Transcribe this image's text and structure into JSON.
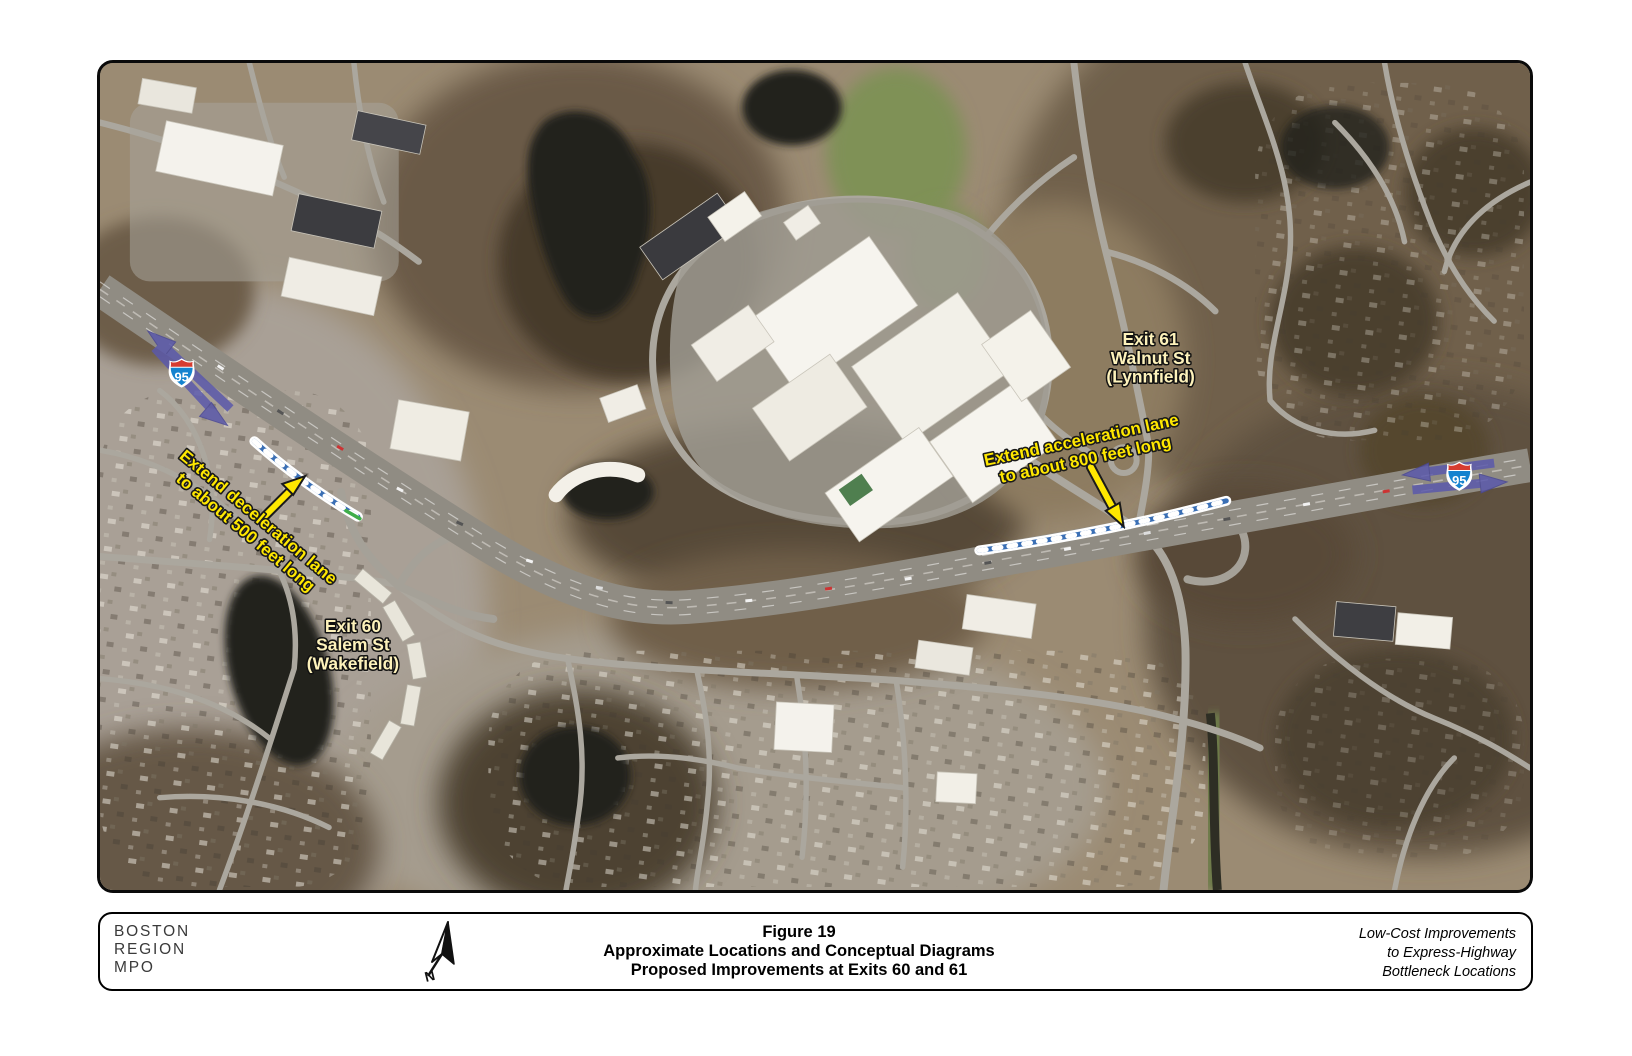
{
  "map": {
    "exit60": {
      "line1": "Exit 60",
      "line2": "Salem St",
      "line3": "(Wakefield)"
    },
    "exit61": {
      "line1": "Exit 61",
      "line2": "Walnut St",
      "line3": "(Lynnfield)"
    },
    "decel_note": {
      "line1": "Extend deceleration lane",
      "line2": "to about 500 feet long"
    },
    "accel_note": {
      "line1": "Extend acceleration lane",
      "line2": "to about 800 feet long"
    },
    "interstate_left": "95",
    "interstate_right": "95"
  },
  "footer": {
    "agency_line1": "BOSTON",
    "agency_line2": "REGION",
    "agency_line3": "MPO",
    "north_letter": "N",
    "figure_line1": "Figure 19",
    "figure_line2": "Approximate Locations and Conceptual Diagrams",
    "figure_line3": "Proposed Improvements at Exits 60 and 61",
    "project_line1": "Low-Cost Improvements",
    "project_line2": "to Express-Highway",
    "project_line3": "Bottleneck Locations"
  },
  "colors": {
    "annotation_yellow": "#ffe800",
    "label_cream": "#fdf2bb",
    "arrow_purple": "#5b59ab",
    "lane_blue": "#3a6fb5",
    "lane_green": "#3fae4a",
    "shield_red": "#d63c30",
    "shield_blue": "#1583cf"
  }
}
